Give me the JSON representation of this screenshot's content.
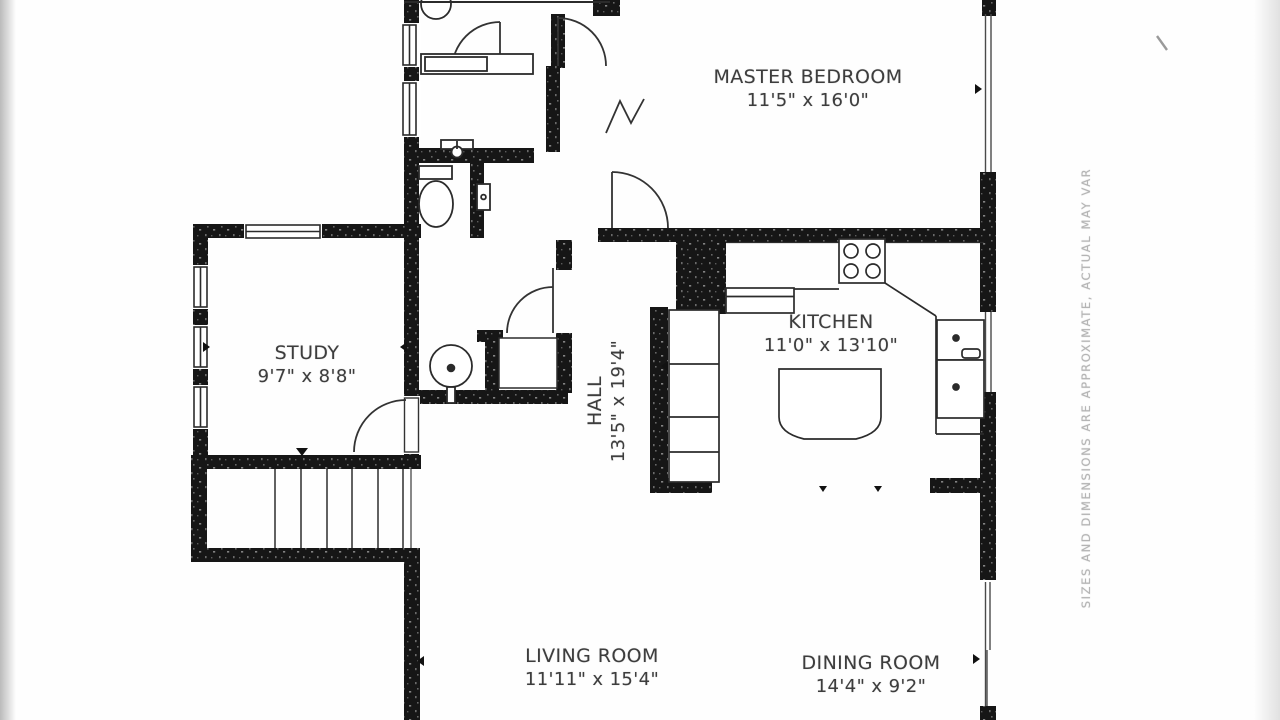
{
  "document": {
    "kind": "floor-plan",
    "background": "#ffffff",
    "wall_color": "#161616",
    "line_color": "#2b2b2b",
    "label_color": "#3d3d3d",
    "muted_color": "#b4b4b4"
  },
  "rooms": [
    {
      "name": "MASTER BEDROOM",
      "dims": "11'5\" x 16'0\""
    },
    {
      "name": "STUDY",
      "dims": "9'7\" x 8'8\""
    },
    {
      "name": "HALL",
      "dims": "13'5\" x 19'4\""
    },
    {
      "name": "KITCHEN",
      "dims": "11'0\" x 13'10\""
    },
    {
      "name": "LIVING ROOM",
      "dims": "11'11\" x 15'4\""
    },
    {
      "name": "DINING ROOM",
      "dims": "14'4\" x 9'2\""
    }
  ],
  "disclaimer": "SIZES AND DIMENSIONS ARE APPROXIMATE, ACTUAL MAY VAR",
  "fixtures": [
    "toilet",
    "pedestal-sink",
    "vanity-sink",
    "wall-sink",
    "shower",
    "stove",
    "refrigerator",
    "kitchen-island",
    "kitchen-cabinets",
    "sink-cabinet",
    "staircase",
    "doors",
    "windows"
  ]
}
